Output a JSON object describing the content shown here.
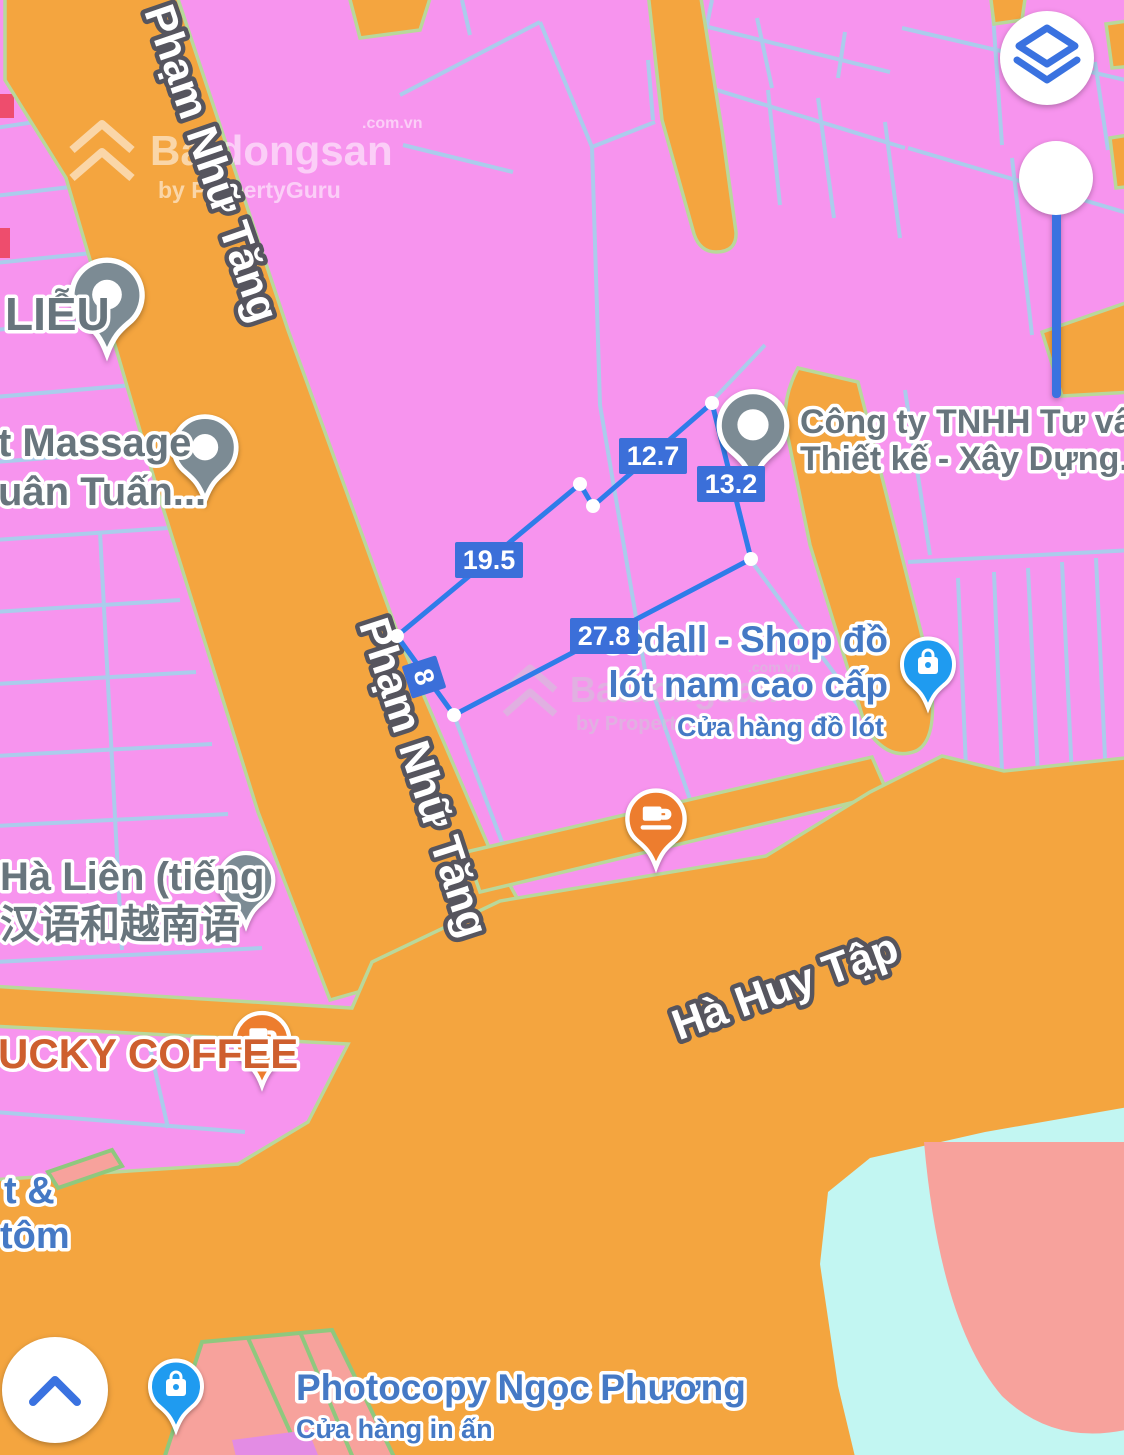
{
  "watermark": {
    "brand": "Batdongsan",
    "domain": ".com.vn",
    "byline": "by PropertyGuru"
  },
  "streets": {
    "pham_nhu_tang": "Phạm Nhữ Tăng",
    "ha_huy_tap": "Hà Huy Tập"
  },
  "measurements": {
    "seg_top": "12.7",
    "seg_right": "13.2",
    "seg_left_upper": "19.5",
    "seg_bottom": "27.8",
    "seg_left_lower": "8"
  },
  "pois": {
    "lieu": {
      "line1": "LIỄU"
    },
    "massage": {
      "line1": "t Massage",
      "line2": "uân Tuấn..."
    },
    "company": {
      "line1": "Công ty TNHH Tư vấn",
      "line2": "Thiết kế - Xây Dựng..."
    },
    "shop": {
      "line1": "eedall - Shop đồ",
      "line2": "lót nam cao cấp",
      "line3": "Cửa hàng đồ lót"
    },
    "ha_lien": {
      "line1": "Hà Liên (tiếng",
      "line2": "汉语和越南语"
    },
    "coffee": {
      "line1": "UCKY COFFEE"
    },
    "tom": {
      "line1": "t &",
      "line2": "tôm"
    },
    "photocopy": {
      "line1": "Photocopy Ngọc Phương",
      "line2": "Cửa hàng in ấn"
    }
  },
  "icons": {
    "layers": "layers-icon",
    "chevron_up": "chevron-up-icon",
    "place_dot": "place-dot-icon",
    "coffee_cup": "coffee-cup-icon",
    "shopping_bag": "shopping-bag-icon",
    "graduation_cap": "graduation-cap-icon"
  },
  "colors": {
    "parcel_pink": "#f794ee",
    "road_orange": "#f4a53f",
    "line_blue": "#abccec",
    "road_edge_green": "#b9d89b",
    "water_cyan": "#c2f6f2",
    "salmon": "#f7a29c",
    "violet_patch": "#e38ce4",
    "red_mark": "#ee4d6d",
    "polygon_blue": "#2f7ce9",
    "measure_bg": "#3b6fd9",
    "poi_grey": "#7c8b94",
    "poi_text_grey": "#68757d",
    "shop_blue": "#4579c5",
    "cafe_pin_orange": "#ed7d2e",
    "cafe_text_orange": "#ce5f2e",
    "bag_blue": "#1f9bf0",
    "control_blue": "#3a72e0",
    "street_outline": "#56555e"
  }
}
